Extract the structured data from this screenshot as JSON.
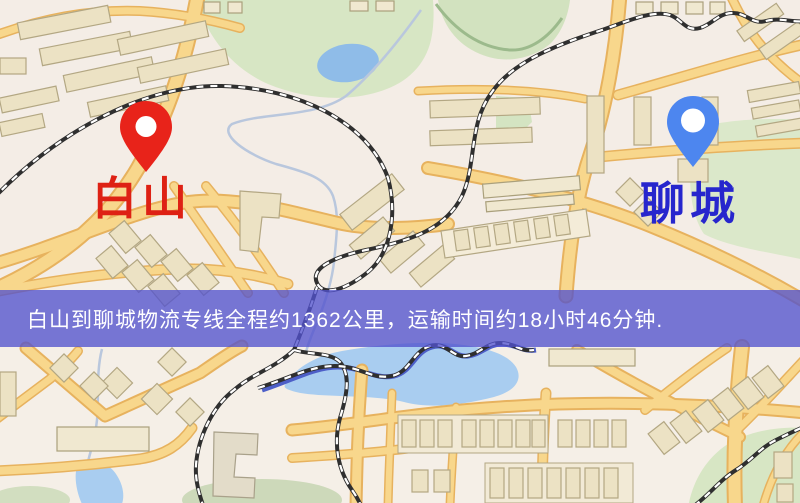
{
  "origin": {
    "label": "白山",
    "pin_color": "#e8231a",
    "label_color": "#de2114"
  },
  "destination": {
    "label": "聊城",
    "pin_color": "#4d86ef",
    "label_color": "#2726cd"
  },
  "banner": {
    "text": "白山到聊城物流专线全程约1362公里，运输时间约18小时46分钟.",
    "bg_color": "#5252cd",
    "text_color": "#ffffff"
  },
  "map": {
    "background_color": "#f5efe7",
    "road_color": "#f8d78c",
    "water_color": "#a9cdf0",
    "green_color": "#d7e6c4",
    "building_color": "#ece2c4",
    "railway_colors": [
      "#2f2f2f",
      "#ffffff"
    ]
  }
}
